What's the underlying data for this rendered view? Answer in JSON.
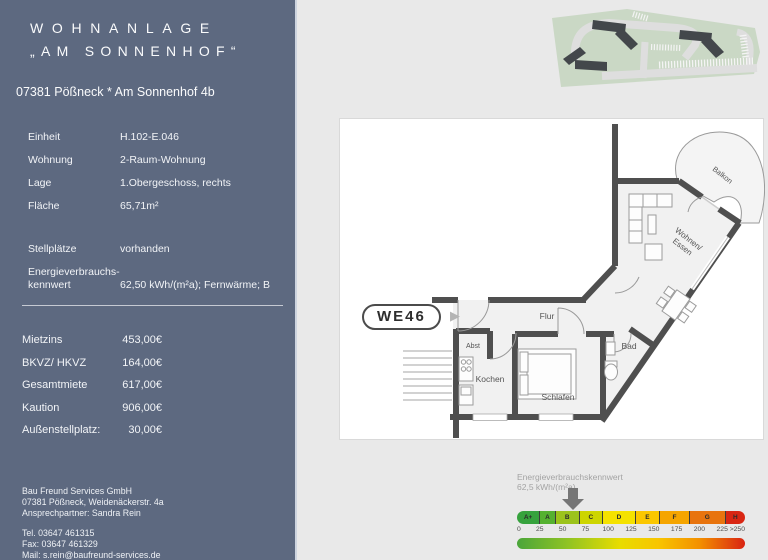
{
  "sidebar": {
    "title_line1": "WOHNANLAGE",
    "title_line2": "„AM SONNENHOF“",
    "address": "07381 Pößneck * Am Sonnenhof 4b",
    "info_rows": [
      {
        "label": "Einheit",
        "value": "H.102-E.046"
      },
      {
        "label": "Wohnung",
        "value": "2-Raum-Wohnung"
      },
      {
        "label": "Lage",
        "value": "1.Obergeschoss, rechts"
      },
      {
        "label": "Fläche",
        "value": "65,71m²"
      }
    ],
    "stellplatz_row": {
      "label": "Stellplätze",
      "value": "vorhanden"
    },
    "energy_row": {
      "label_line1": "Energieverbrauchs-",
      "label_line2": "kennwert",
      "value": "62,50 kWh/(m²a); Fernwärme; B"
    },
    "price_rows": [
      {
        "label": "Mietzins",
        "value": "453,00€"
      },
      {
        "label": "BKVZ/ HKVZ",
        "value": "164,00€"
      },
      {
        "label": "Gesamtmiete",
        "value": "617,00€"
      },
      {
        "label": "Kaution",
        "value": "906,00€"
      },
      {
        "label": "Außenstellplatz:",
        "value": "30,00€"
      }
    ],
    "contact": {
      "company": "Bau Freund Services GmbH",
      "address": "07381 Pößneck, Weidenäckerstr. 4a",
      "person": "Ansprechpartner: Sandra Rein",
      "tel": "Tel. 03647 461315",
      "fax": "Fax: 03647 461329",
      "mail": "Mail: s.rein@baufreund-services.de"
    }
  },
  "floorplan": {
    "unit_label": "WE46",
    "arrow_icon": "▶",
    "rooms": {
      "flur": "Flur",
      "abst": "Abst",
      "kochen": "Kochen",
      "schlafen": "Schlafen",
      "bad": "Bad",
      "wohnen_line1": "Wohnen/",
      "wohnen_line2": "Essen",
      "balkon": "Balkon"
    }
  },
  "energy_scale": {
    "title": "Energieverbrauchskennwert",
    "value_label": "62,5 kWh/(m²a)",
    "value": 62.5,
    "scale_max": 255,
    "classes": [
      {
        "label": "A+",
        "color": "#36a23d",
        "flex": 23
      },
      {
        "label": "A",
        "color": "#55b130",
        "flex": 15
      },
      {
        "label": "B",
        "color": "#9cc31c",
        "flex": 24
      },
      {
        "label": "C",
        "color": "#cdd500",
        "flex": 23
      },
      {
        "label": "D",
        "color": "#f5e200",
        "flex": 33
      },
      {
        "label": "E",
        "color": "#fbc700",
        "flex": 24
      },
      {
        "label": "F",
        "color": "#f5a500",
        "flex": 30
      },
      {
        "label": "G",
        "color": "#e8740e",
        "flex": 36
      },
      {
        "label": "H",
        "color": "#d92613",
        "flex": 20
      }
    ],
    "ticks": [
      "0",
      "25",
      "50",
      "75",
      "100",
      "125",
      "150",
      "175",
      "200",
      "225",
      ">250"
    ]
  },
  "colors": {
    "sidebar": "#5d6980",
    "page_bg": "#e9e9e9",
    "wall": "#4f4f4f"
  }
}
